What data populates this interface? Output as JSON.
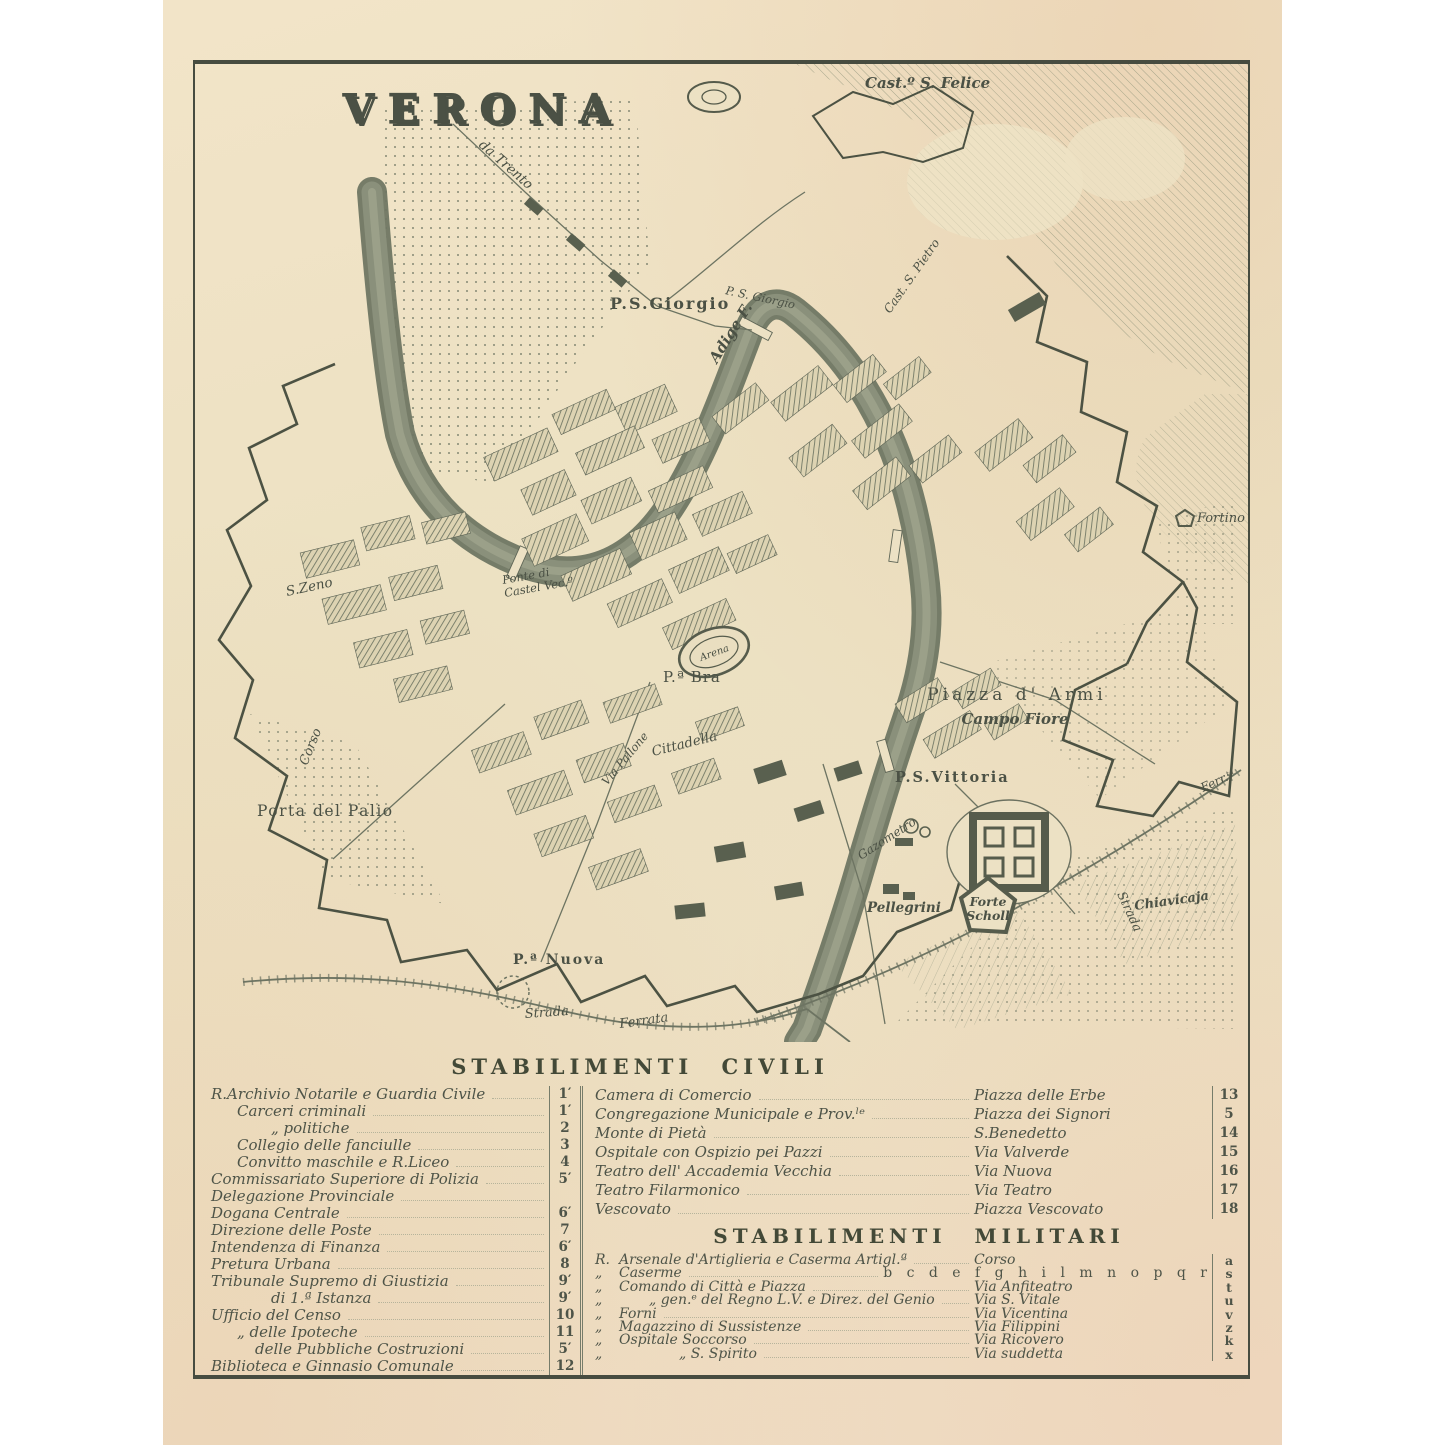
{
  "page": {
    "background": "#ffffff",
    "paper_color": "#ece1c4",
    "ink_color": "#4b5145"
  },
  "map": {
    "title": "VERONA",
    "labels": {
      "castel_s_felice": "Cast.º S. Felice",
      "da_trento": "da Trento",
      "ps_giorgio": "P.S.Giorgio",
      "ps_giorgio_small": "P. S. Giorgio",
      "adige": "Adige F.",
      "cast_s_pietro": "Cast. S. Pietro",
      "fortino": "Fortino",
      "s_zeno": "S.Zeno",
      "ponte_castelvecchio_1": "Ponte di",
      "ponte_castelvecchio_2": "Castel Vec.º",
      "pa_bra": "P.ª Bra",
      "arena": "Arena",
      "corso": "Corso",
      "cittadella": "Cittadella",
      "via_pallone": "Via Pallone",
      "piazza_d_armi": "Piazza d' Armi",
      "campo_fiore": "Campo Fiore",
      "ps_vittoria": "P.S.Vittoria",
      "porta_del_palio": "Porta del Palio",
      "gazometro": "Gazometro",
      "forte_scholl_1": "Forte",
      "forte_scholl_2": "Scholl",
      "pellegrini": "Pellegrini",
      "strada": "Strada",
      "chiavica": "Chiavicaja",
      "ferrata_right": "Ferr.ᵗᵃ",
      "strada_ferrata_1": "Strada",
      "strada_ferrata_2": "Ferrata",
      "p_nuova": "P.ª Nuova"
    }
  },
  "legend": {
    "civil_title": "STABILIMENTI CIVILI",
    "military_title": "STABILIMENTI MILITARI",
    "civil_left": [
      {
        "name": "R.Archivio Notarile e Guardia Civile",
        "num": "1′"
      },
      {
        "name": "Carceri criminali",
        "num": "1′"
      },
      {
        "name": "„    politiche",
        "num": "2"
      },
      {
        "name": "Collegio delle fanciulle",
        "num": "3"
      },
      {
        "name": "Convitto maschile e  R.Liceo",
        "num": "4"
      },
      {
        "name": "Commissariato Superiore di Polizia",
        "num": "5′"
      },
      {
        "name": "Delegazione Provinciale",
        "num": ""
      },
      {
        "name": "Dogana Centrale",
        "num": "6′"
      },
      {
        "name": "Direzione delle Poste",
        "num": "7"
      },
      {
        "name": "Intendenza di Finanza",
        "num": "6′"
      },
      {
        "name": "Pretura Urbana",
        "num": "8"
      },
      {
        "name": "Tribunale Supremo di Giustizia",
        "num": "9′"
      },
      {
        "name": "di 1.ª Istanza",
        "num": "9′"
      },
      {
        "name": "Ufficio del Censo",
        "num": "10"
      },
      {
        "name": "„   delle Ipoteche",
        "num": "11"
      },
      {
        "name": "delle Pubbliche Costruzioni",
        "num": "5′"
      },
      {
        "name": "Biblioteca e Ginnasio Comunale",
        "num": "12"
      }
    ],
    "civil_right": [
      {
        "name": "Camera di Comercio",
        "place": "Piazza delle Erbe",
        "num": "13"
      },
      {
        "name": "Congregazione Municipale e Prov.ˡᵉ",
        "place": "Piazza dei Signori",
        "num": "5"
      },
      {
        "name": "Monte di Pietà",
        "place": "S.Benedetto",
        "num": "14"
      },
      {
        "name": "Ospitale con Ospizio pei Pazzi",
        "place": "Via Valverde",
        "num": "15"
      },
      {
        "name": "Teatro dell' Accademia Vecchia",
        "place": "Via Nuova",
        "num": "16"
      },
      {
        "name": "Teatro Filarmonico",
        "place": "Via Teatro",
        "num": "17"
      },
      {
        "name": "Vescovato",
        "place": "Piazza Vescovato",
        "num": "18"
      }
    ],
    "military": [
      {
        "prefix": "R.",
        "name": "Arsenale d'Artiglieria e Caserma Artigl.ª",
        "place": "Corso",
        "num": "a"
      },
      {
        "prefix": "„",
        "name": "Caserme",
        "place": "b c d e f g h i l m n o p q r",
        "num": "s"
      },
      {
        "prefix": "„",
        "name": "Comando di Città e Piazza",
        "place": "Via Anfiteatro",
        "num": "t"
      },
      {
        "prefix": "„",
        "name": "„  gen.ᵉ del Regno L.V. e Direz. del Genio",
        "place": "Via S. Vitale",
        "num": "u"
      },
      {
        "prefix": "„",
        "name": "Forni",
        "place": "Via Vicentina",
        "num": "v"
      },
      {
        "prefix": "„",
        "name": "Magazzino di Sussistenze",
        "place": "Via Filippini",
        "num": "z"
      },
      {
        "prefix": "„",
        "name": "Ospitale Soccorso",
        "place": "Via Ricovero",
        "num": "k"
      },
      {
        "prefix": "„",
        "name": "„     S. Spirito",
        "place": "Via suddetta",
        "num": "x"
      }
    ]
  }
}
